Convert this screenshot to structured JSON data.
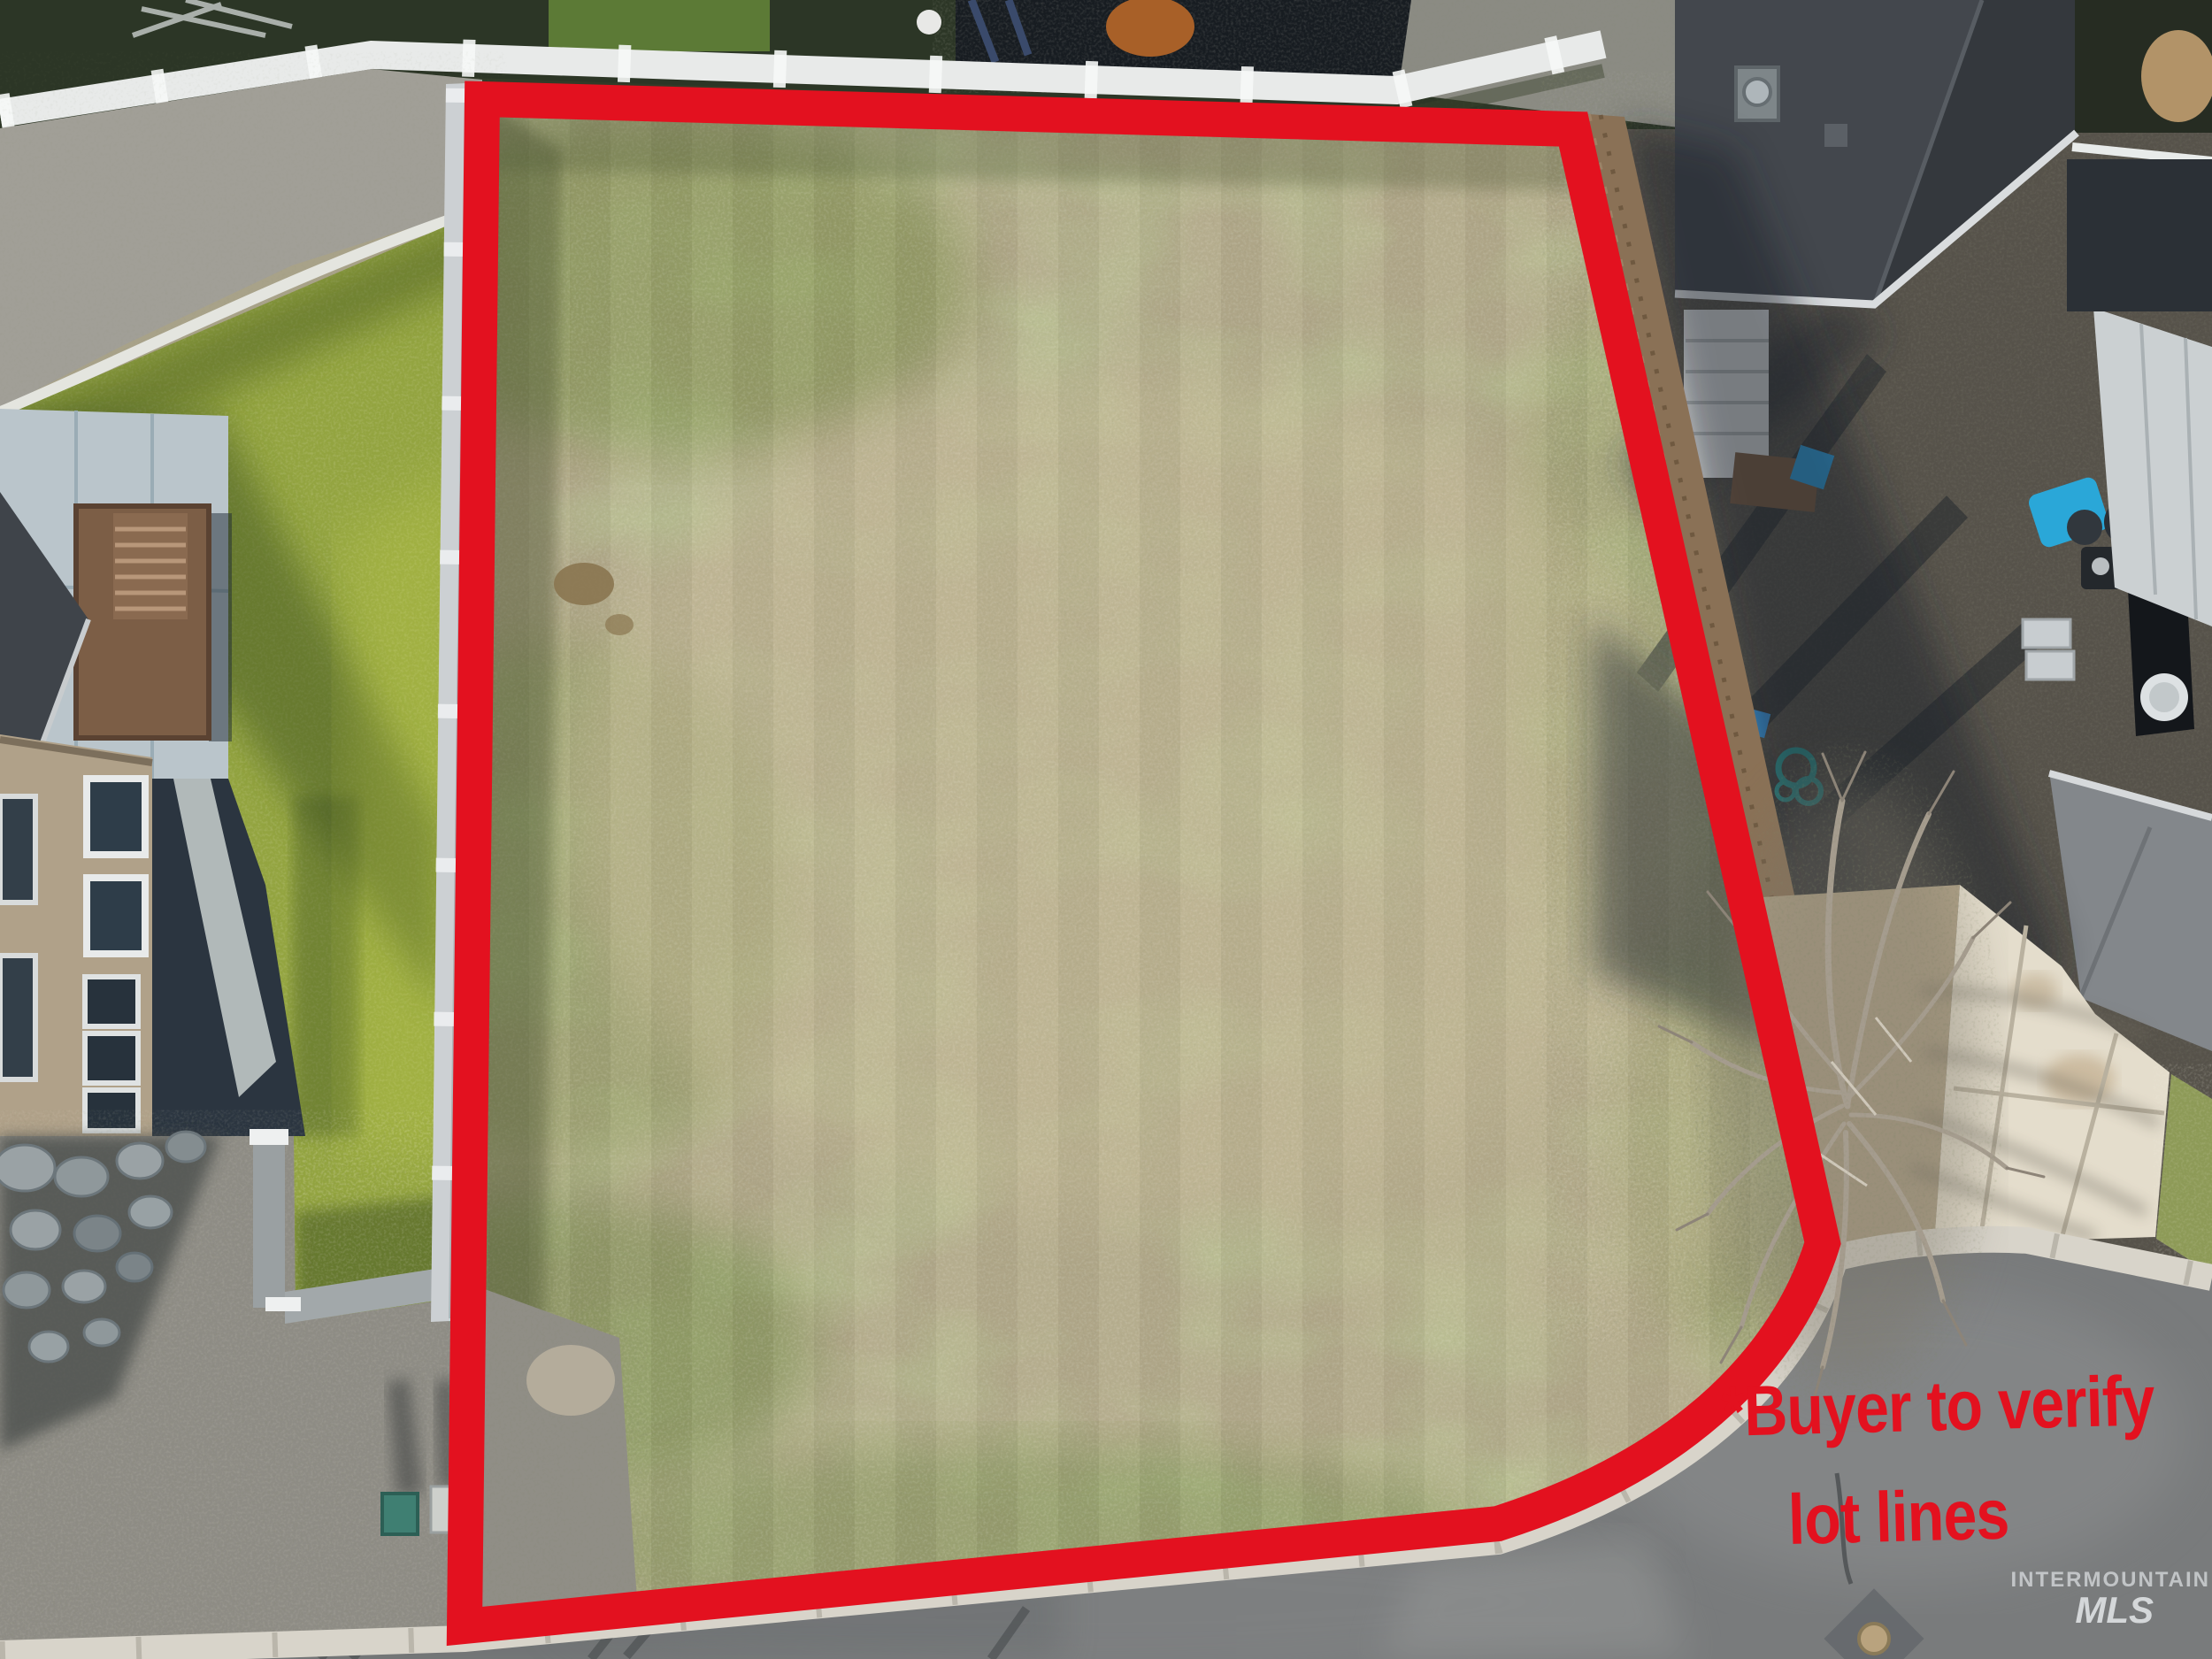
{
  "photo": {
    "description": "Aerial drone photo of a vacant residential lot outlined in red beside a cul-de-sac",
    "disclaimer": {
      "line1": "*Buyer to verify",
      "line2": "lot lines"
    },
    "watermark": {
      "line1": "INTERMOUNTAIN",
      "line2": "MLS"
    },
    "colors": {
      "accent-red": "#e3111f",
      "watermark-text": "#eef1f3",
      "lot-grass-dry": "#b4ab8c",
      "lot-grass-green": "#85985a",
      "lawn-green": "#93a440",
      "asphalt": "#797b7c",
      "curb": "#d8d4ca",
      "driveway-concrete": "#e4ddcc",
      "roof-dark": "#43474d",
      "wood-fence": "#8a7156",
      "vinyl-fence": "#ccd0d3"
    }
  }
}
